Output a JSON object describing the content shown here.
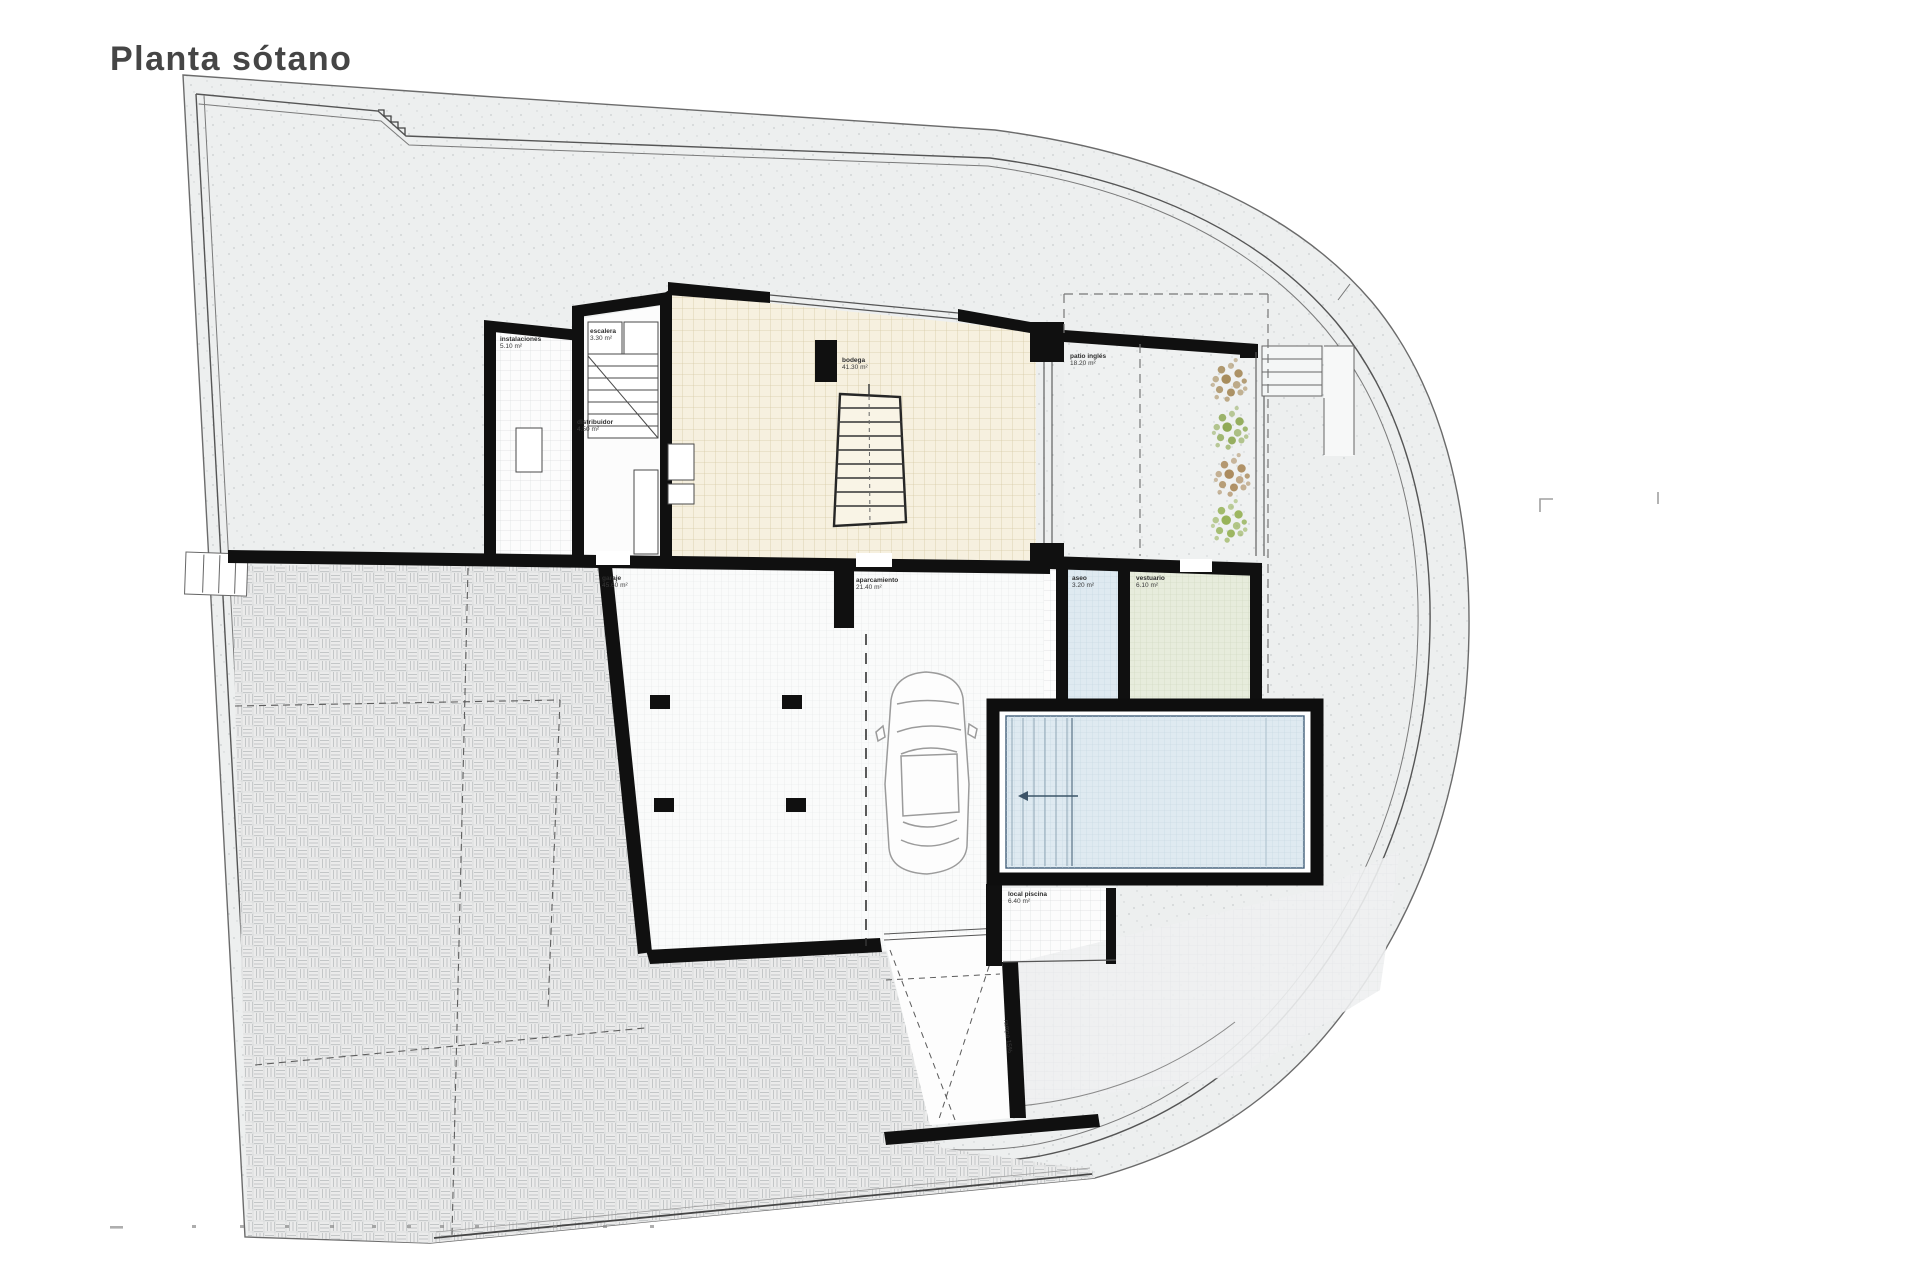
{
  "title": "Planta sótano",
  "colors": {
    "ink": "#101010",
    "site": "#edefef",
    "paving": "#ebebeb",
    "beige_floor": "#f6f0df",
    "pool_water": "#dfeaf1",
    "aseo_floor": "#dfeaf1",
    "vestuario_floor": "#e7ecdc",
    "plant_brown": "#9b7b43",
    "plant_green": "#7f9e3c",
    "plant_brown2": "#a07a45",
    "plant_green2": "#88a83f"
  },
  "rooms": {
    "instalaciones": {
      "name": "instalaciones",
      "area": "5.10 m²"
    },
    "escalera": {
      "name": "escalera",
      "area": "3.30 m²"
    },
    "distribuidor": {
      "name": "distribuidor",
      "area": "4.50 m²"
    },
    "bodega": {
      "name": "bodega",
      "area": "41.30 m²"
    },
    "garaje": {
      "name": "garaje",
      "area": "45.60 m²"
    },
    "aparcamiento": {
      "name": "aparcamiento",
      "area": "21.40 m²"
    },
    "patio": {
      "name": "patio inglés",
      "area": "18.20 m²"
    },
    "aseo": {
      "name": "aseo",
      "area": "3.20 m²"
    },
    "vestuario": {
      "name": "vestuario",
      "area": "6.10 m²"
    },
    "local_piscina": {
      "name": "local piscina",
      "area": "6.40 m²"
    },
    "rampa": {
      "name": "rampa 15%"
    }
  }
}
